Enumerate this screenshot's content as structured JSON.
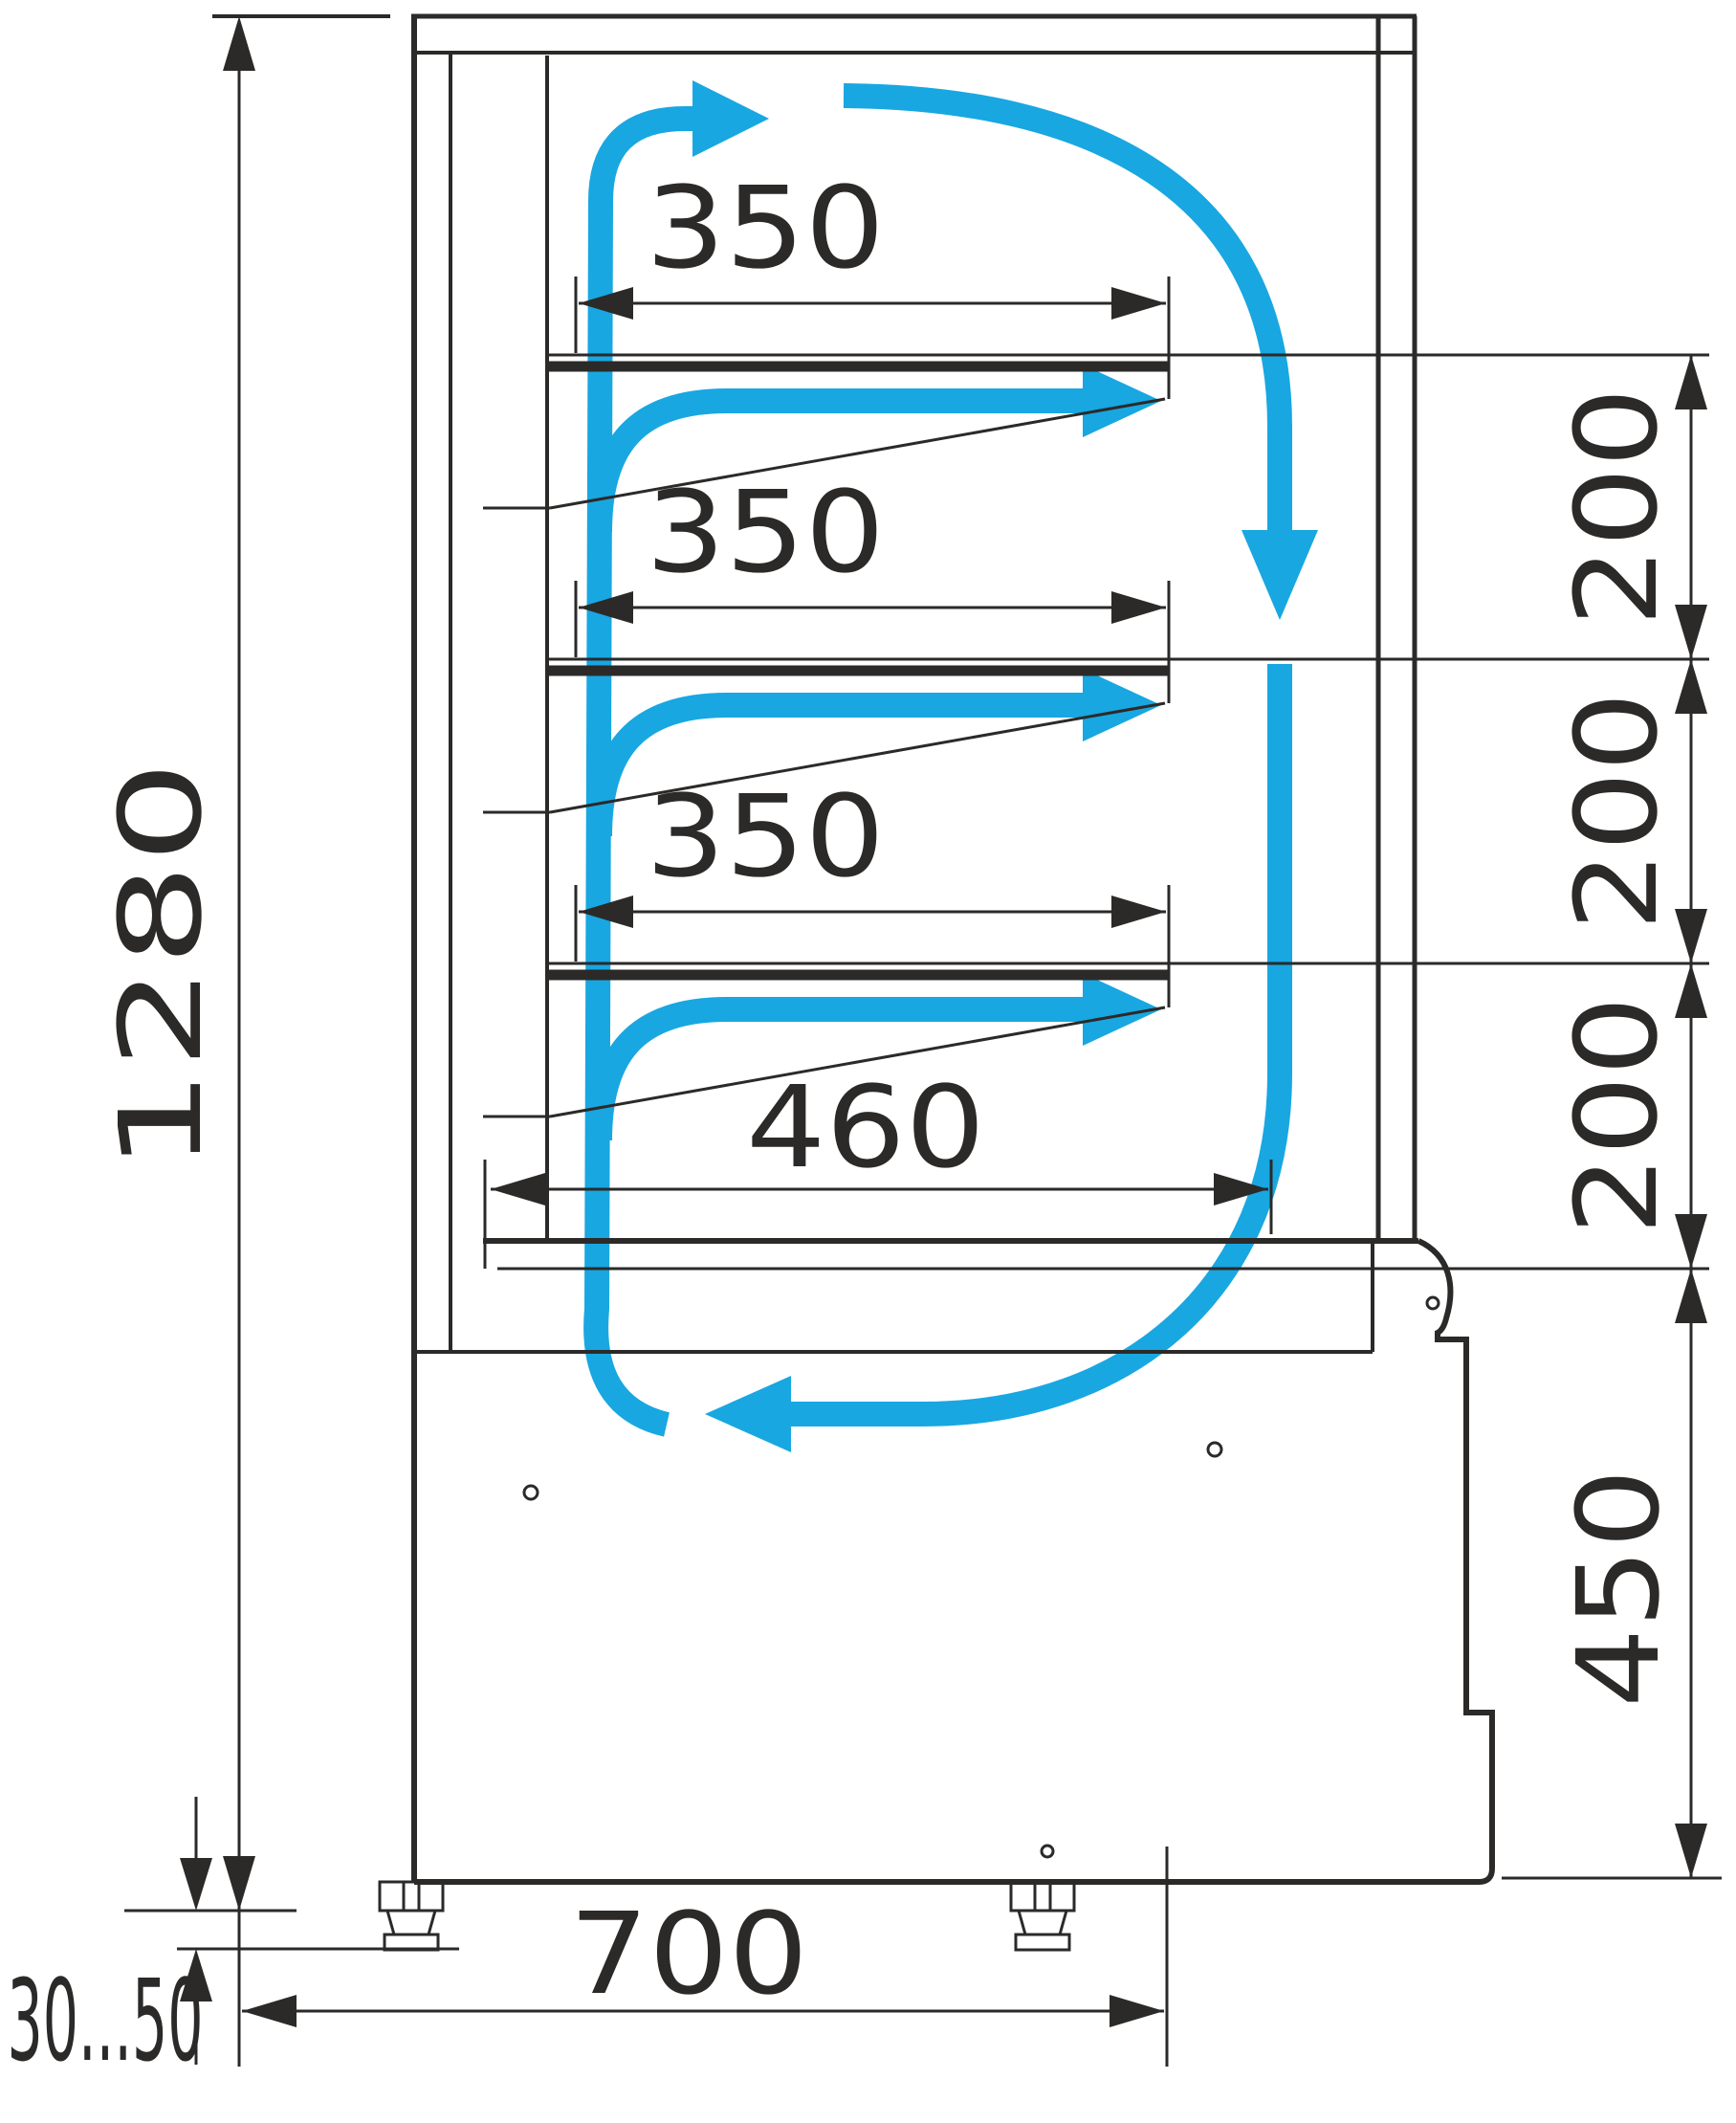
{
  "drawing": {
    "kind": "display-case-side-section-airflow-diagram"
  },
  "colors": {
    "line": "#2B2A29",
    "flow": "#18A7E1",
    "background": "#FFFFFF"
  },
  "dimensions": {
    "overall_height": {
      "label": "1280"
    },
    "shelf_depths": [
      {
        "label": "350"
      },
      {
        "label": "350"
      },
      {
        "label": "350"
      }
    ],
    "base_shelf_depth": {
      "label": "460"
    },
    "shelf_spacings": [
      {
        "label": "200"
      },
      {
        "label": "200"
      },
      {
        "label": "200"
      }
    ],
    "base_height": {
      "label": "450"
    },
    "base_depth": {
      "label": "700"
    },
    "foot_adjust_range": {
      "label": "30...50"
    }
  }
}
